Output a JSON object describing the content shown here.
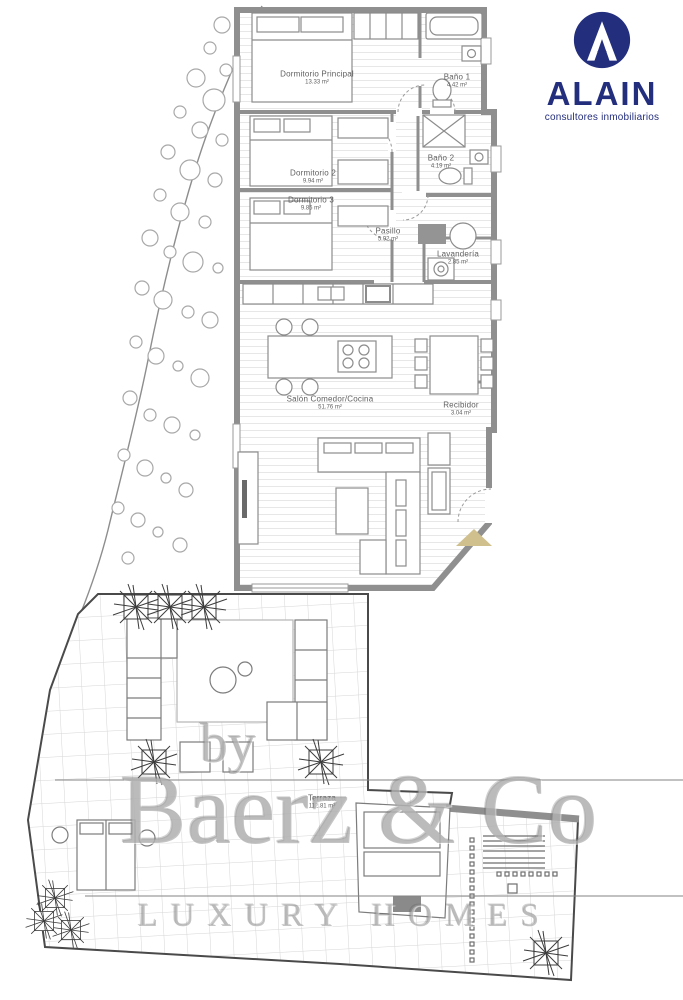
{
  "logo": {
    "name": "ALAIN",
    "tagline": "consultores inmobiliarios",
    "color": "#232e7d"
  },
  "rooms": [
    {
      "id": "dormitorio-principal",
      "label": "Dormitorio Principal",
      "area": "13.33 m²"
    },
    {
      "id": "bano-1",
      "label": "Baño 1",
      "area": "4.42 m²"
    },
    {
      "id": "dormitorio-2",
      "label": "Dormitorio 2",
      "area": "9.94 m²"
    },
    {
      "id": "bano-2",
      "label": "Baño 2",
      "area": "4.19 m²"
    },
    {
      "id": "dormitorio-3",
      "label": "Dormitorio 3",
      "area": "9.85 m²"
    },
    {
      "id": "pasillo",
      "label": "Pasillo",
      "area": "5.92 m²"
    },
    {
      "id": "lavanderia",
      "label": "Lavandería",
      "area": "2.85 m²"
    },
    {
      "id": "salon-comedor-cocina",
      "label": "Salón Comedor/Cocina",
      "area": "51.76 m²"
    },
    {
      "id": "recibidor",
      "label": "Recibidor",
      "area": "3.04 m²"
    },
    {
      "id": "terraza",
      "label": "Terraza",
      "area": "112.81 m²"
    }
  ],
  "watermark": {
    "prefix": "by",
    "brand": "Baerz & Co",
    "tagline": "LUXURY HOMES"
  },
  "colors": {
    "wall": "#8f8f8f",
    "logo_navy": "#232e7d",
    "entrance_arrow": "#cfc08e"
  }
}
